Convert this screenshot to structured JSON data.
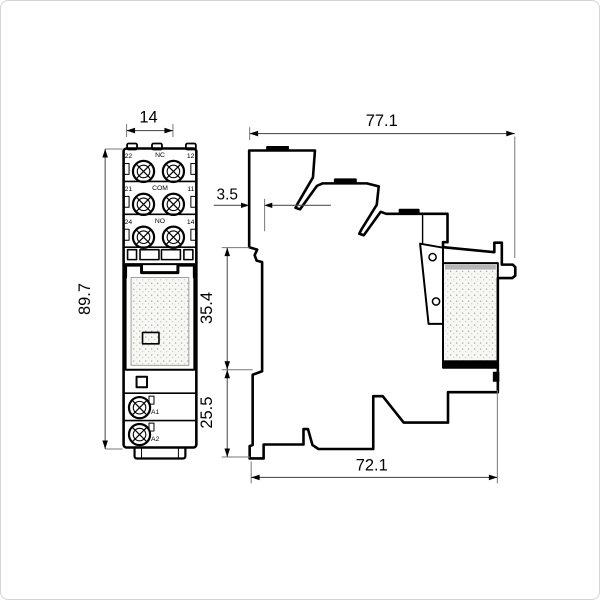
{
  "drawing": {
    "front_view": {
      "width_label": "14",
      "height_label": "89.7",
      "terminal_rows": [
        {
          "left": "22",
          "center": "NC",
          "right": "12"
        },
        {
          "left": "21",
          "center": "COM",
          "right": "11"
        },
        {
          "left": "24",
          "center": "NO",
          "right": "14"
        }
      ],
      "coil_terminals": [
        "A1",
        "A2"
      ]
    },
    "side_view": {
      "overall_depth_label": "77.1",
      "bottom_depth_label": "72.1",
      "rail_offset_label": "3.5",
      "upper_height_label": "35.4",
      "lower_height_label": "25.5"
    },
    "colors": {
      "line": "#000000",
      "dimension_line": "#555555",
      "stipple_dot": "#9b9b9b",
      "label_band": "#b5b5b5"
    }
  }
}
